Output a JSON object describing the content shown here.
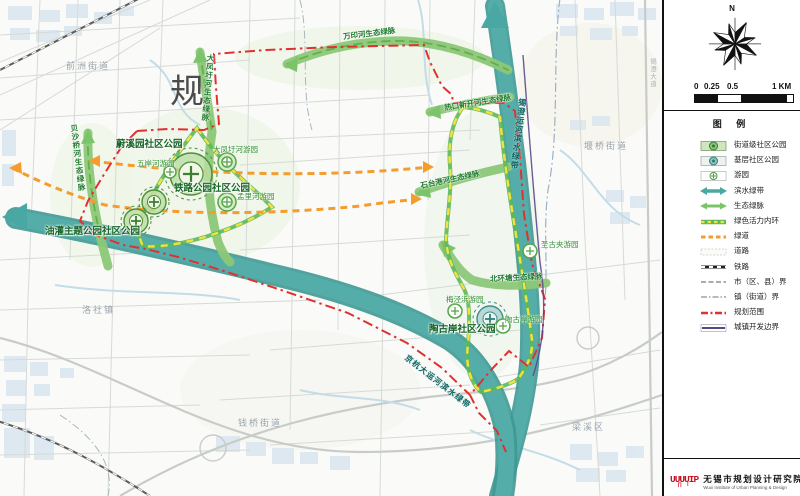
{
  "colors": {
    "waterbelt_teal": "#4AA8A4",
    "eco_green": "#7CC46A",
    "ring_green": "#5CB85C",
    "ring_yellow": "#F3E23C",
    "greenway_orange": "#F49C2D",
    "plan_red": "#E03131",
    "dev_purple": "#5B4A8A",
    "park_green": "#4E8F3A",
    "park_teal": "#3F8E8A"
  },
  "map": {
    "watermark": "规",
    "districts": [
      "前洲街道",
      "洛社镇",
      "钱桥街道",
      "堰桥街道",
      "梁溪区"
    ],
    "roads": [
      "锡澄大道"
    ],
    "parks": [
      "蔚溪园社区公园",
      "铁路公园社区公园",
      "油灌主题公园社区公园",
      "陶古岸社区公园"
    ],
    "gardens": [
      "五岸河游园",
      "大凤圩河游园",
      "孟里河游园",
      "圣古夹游园",
      "梅泾浜游园",
      "陶古岸游园"
    ],
    "corridors": [
      "万印河生态绿脉",
      "大凤圩河生态绿脉",
      "贝沙桥河生态绿脉",
      "热口新开河生态绿脉",
      "石台港河生态绿脉",
      "北环塘生态绿脉"
    ],
    "waterbelts": [
      "锡澄运河滨水绿带",
      "京杭大运河滨水绿带"
    ]
  },
  "panel": {
    "north": "N",
    "scale_ticks": [
      "0",
      "0.25",
      "0.5",
      "1 KM"
    ],
    "legend_title": "图 例",
    "legend_items": [
      "街道级社区公园",
      "基层社区公园",
      "游园",
      "滨水绿带",
      "生态绿脉",
      "绿色活力内环",
      "绿道",
      "道路",
      "铁路",
      "市（区、县）界",
      "镇（街道）界",
      "规划范围",
      "城镇开发边界"
    ],
    "logo": {
      "mark": "UUUUIP",
      "mark2": "∏ I",
      "cn": "无锡市规划设计研究院",
      "en": "Wuxi Institute of Urban Planning & Design"
    }
  }
}
